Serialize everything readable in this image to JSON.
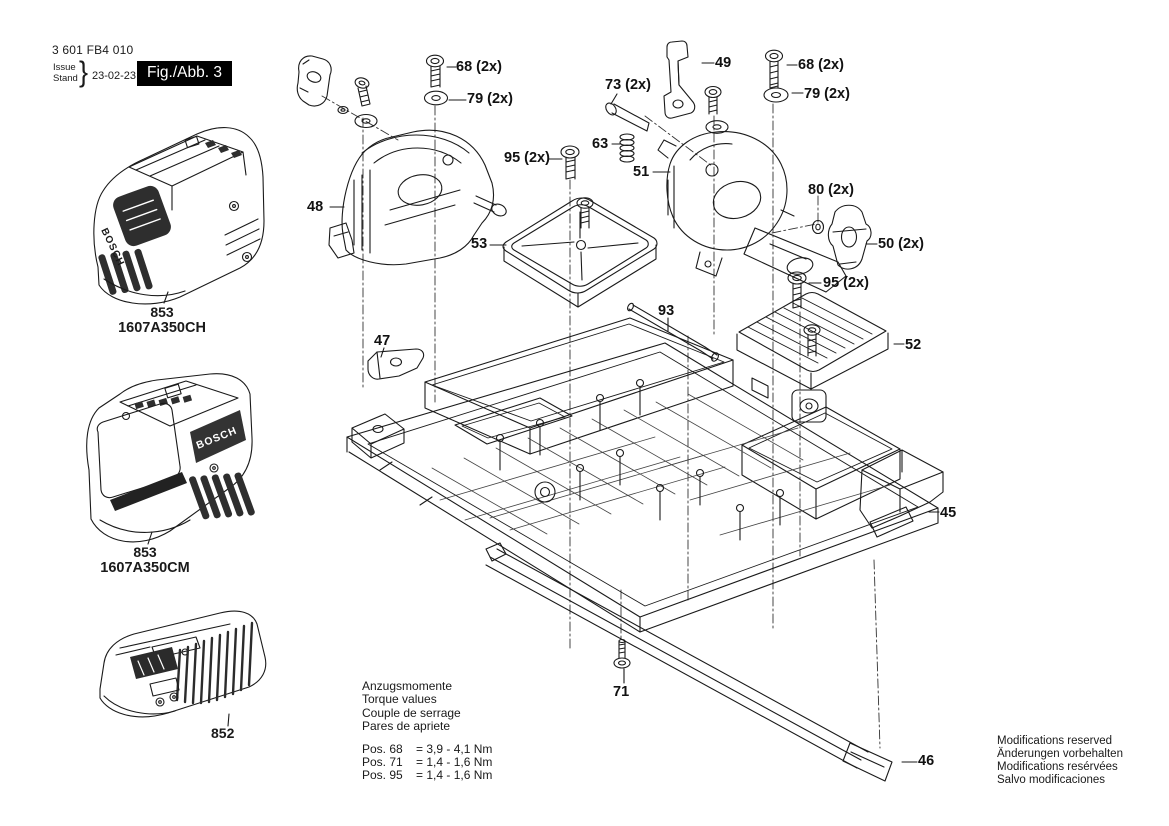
{
  "header": {
    "part_number": "3 601 FB4 010",
    "issue_label_top": "Issue",
    "issue_label_bottom": "Stand",
    "brace": "}",
    "date": "23-02-23",
    "figure_label": "Fig./Abb. 3",
    "figure_box_bg": "#000000",
    "figure_box_fg": "#ffffff"
  },
  "products": {
    "battery_ch": {
      "ref": "853",
      "model": "1607A350CH",
      "brand": "BOSCH"
    },
    "battery_cm": {
      "ref": "853",
      "model": "1607A350CM",
      "brand": "BOSCH"
    },
    "charger": {
      "ref": "852"
    }
  },
  "callouts": {
    "n45": "45",
    "n46": "46",
    "n47": "47",
    "n48": "48",
    "n49": "49",
    "n50": "50 (2x)",
    "n51": "51",
    "n52": "52",
    "n53": "53",
    "n63": "63",
    "n68_left": "68 (2x)",
    "n68_right": "68 (2x)",
    "n71": "71",
    "n73": "73 (2x)",
    "n79_left": "79 (2x)",
    "n79_right": "79 (2x)",
    "n80": "80 (2x)",
    "n93": "93",
    "n95_left": "95 (2x)",
    "n95_right": "95 (2x)"
  },
  "torque_note": {
    "title_de": "Anzugsmomente",
    "title_en": "Torque values",
    "title_fr": "Couple de serrage",
    "title_es": "Pares de apriete",
    "rows": [
      {
        "pos": "Pos. 68",
        "value": "= 3,9 - 4,1 Nm"
      },
      {
        "pos": "Pos. 71",
        "value": "= 1,4 - 1,6 Nm"
      },
      {
        "pos": "Pos. 95",
        "value": "= 1,4 - 1,6 Nm"
      }
    ]
  },
  "footer_note": {
    "en": "Modifications reserved",
    "de": "Änderungen vorbehalten",
    "fr": "Modifications resérvées",
    "es": "Salvo modificaciones"
  },
  "colors": {
    "line": "#1a1a1a",
    "dark_fill": "#2e2e2e"
  }
}
